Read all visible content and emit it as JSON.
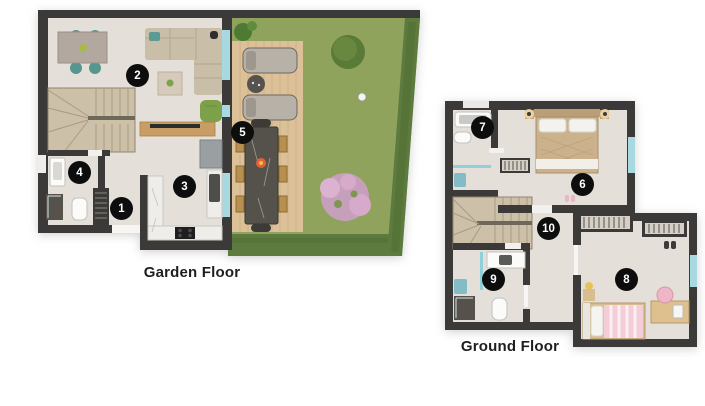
{
  "floors": [
    {
      "label": "Garden Floor",
      "markers": [
        {
          "number": "1"
        },
        {
          "number": "2"
        },
        {
          "number": "3"
        },
        {
          "number": "4"
        },
        {
          "number": "5"
        }
      ]
    },
    {
      "label": "Ground Floor",
      "markers": [
        {
          "number": "6"
        },
        {
          "number": "7"
        },
        {
          "number": "8"
        },
        {
          "number": "9"
        },
        {
          "number": "10"
        }
      ]
    }
  ],
  "colors": {
    "wall": "#3b3a38",
    "floor": "#e4dfd8",
    "stairs": "#cdc0a8",
    "deck": "#dcc097",
    "grass": "#8fa35c",
    "hedge": "#5d7b3e",
    "glass": "#a9d9e0",
    "counter_marble": "#efedea",
    "sofa": "#c9bea7",
    "chair_teal": "#57958f",
    "armchair_green": "#7da04b",
    "wood": "#c99e66",
    "bed_duvet": "#cbb28d",
    "kids_pink": "#f3cdd8",
    "marker_bg": "#0d0d0d",
    "marker_text": "#ffffff",
    "label_text": "#1e1e1e"
  }
}
